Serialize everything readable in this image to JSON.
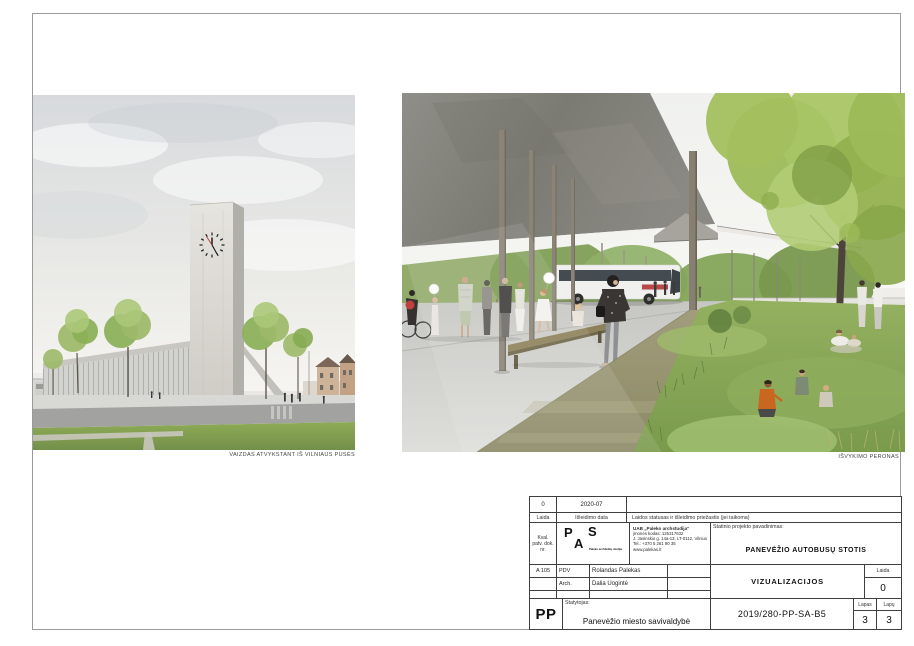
{
  "sheet": {
    "views": [
      {
        "id": "tower-view",
        "caption": "VAIZDAS ATVYKSTANT IŠ VILNIAUS PUSĖS"
      },
      {
        "id": "platform-view",
        "caption": "IŠVYKIMO PERONAS"
      }
    ],
    "titleblock": {
      "revision": {
        "laida_value": "0",
        "date_value": "2020-07",
        "status_value": ""
      },
      "labels": {
        "laida": "Laida",
        "date": "Išleidimo data",
        "status": "Laidos statusas ir išleidimo priežastis (jei taikoma)",
        "kval": "Kval. patv. dok. nr.",
        "project": "Statinio projekto pavadinimas:",
        "client": "Statytojas:",
        "laida2": "Laida",
        "lapas": "Lapas",
        "lapu": "Lapų"
      },
      "qualification_no": "A 105",
      "logo": {
        "p": "P",
        "a": "A",
        "s": "S",
        "studio": "Paleko architektų studija"
      },
      "company": {
        "name": "UAB „Paleko archstudija“",
        "code": "įmonės kodas: 125317632",
        "address": "J. Jasinskio g. 14a-13, LT-0112, Vilnius",
        "phone": "Tel.: +370 5 261 90 35",
        "web": "www.palekas.lt"
      },
      "project_name": "PANEVĖŽIO AUTOBUSŲ STOTIS",
      "team": [
        {
          "role": "PDV",
          "name": "Rolandas Palekas"
        },
        {
          "role": "Arch.",
          "name": "Dalia Uogintė"
        }
      ],
      "drawing_title": "VIZUALIZACIJOS",
      "laida_value": "0",
      "client_code": "PP",
      "client_name": "Panevėžio miesto savivaldybė",
      "document_no": "2019/280-PP-SA-B5",
      "lapas_value": "3",
      "lapu_value": "3"
    }
  },
  "palette": {
    "sky": "#e6e8e6",
    "concrete": "#d8d6d1",
    "canopy_dark": "#85847d",
    "foliage": "#95b464",
    "grass": "#85a251",
    "path_olive": "#96926f",
    "accent_red": "#b23636",
    "line": "#3f3f3f"
  }
}
